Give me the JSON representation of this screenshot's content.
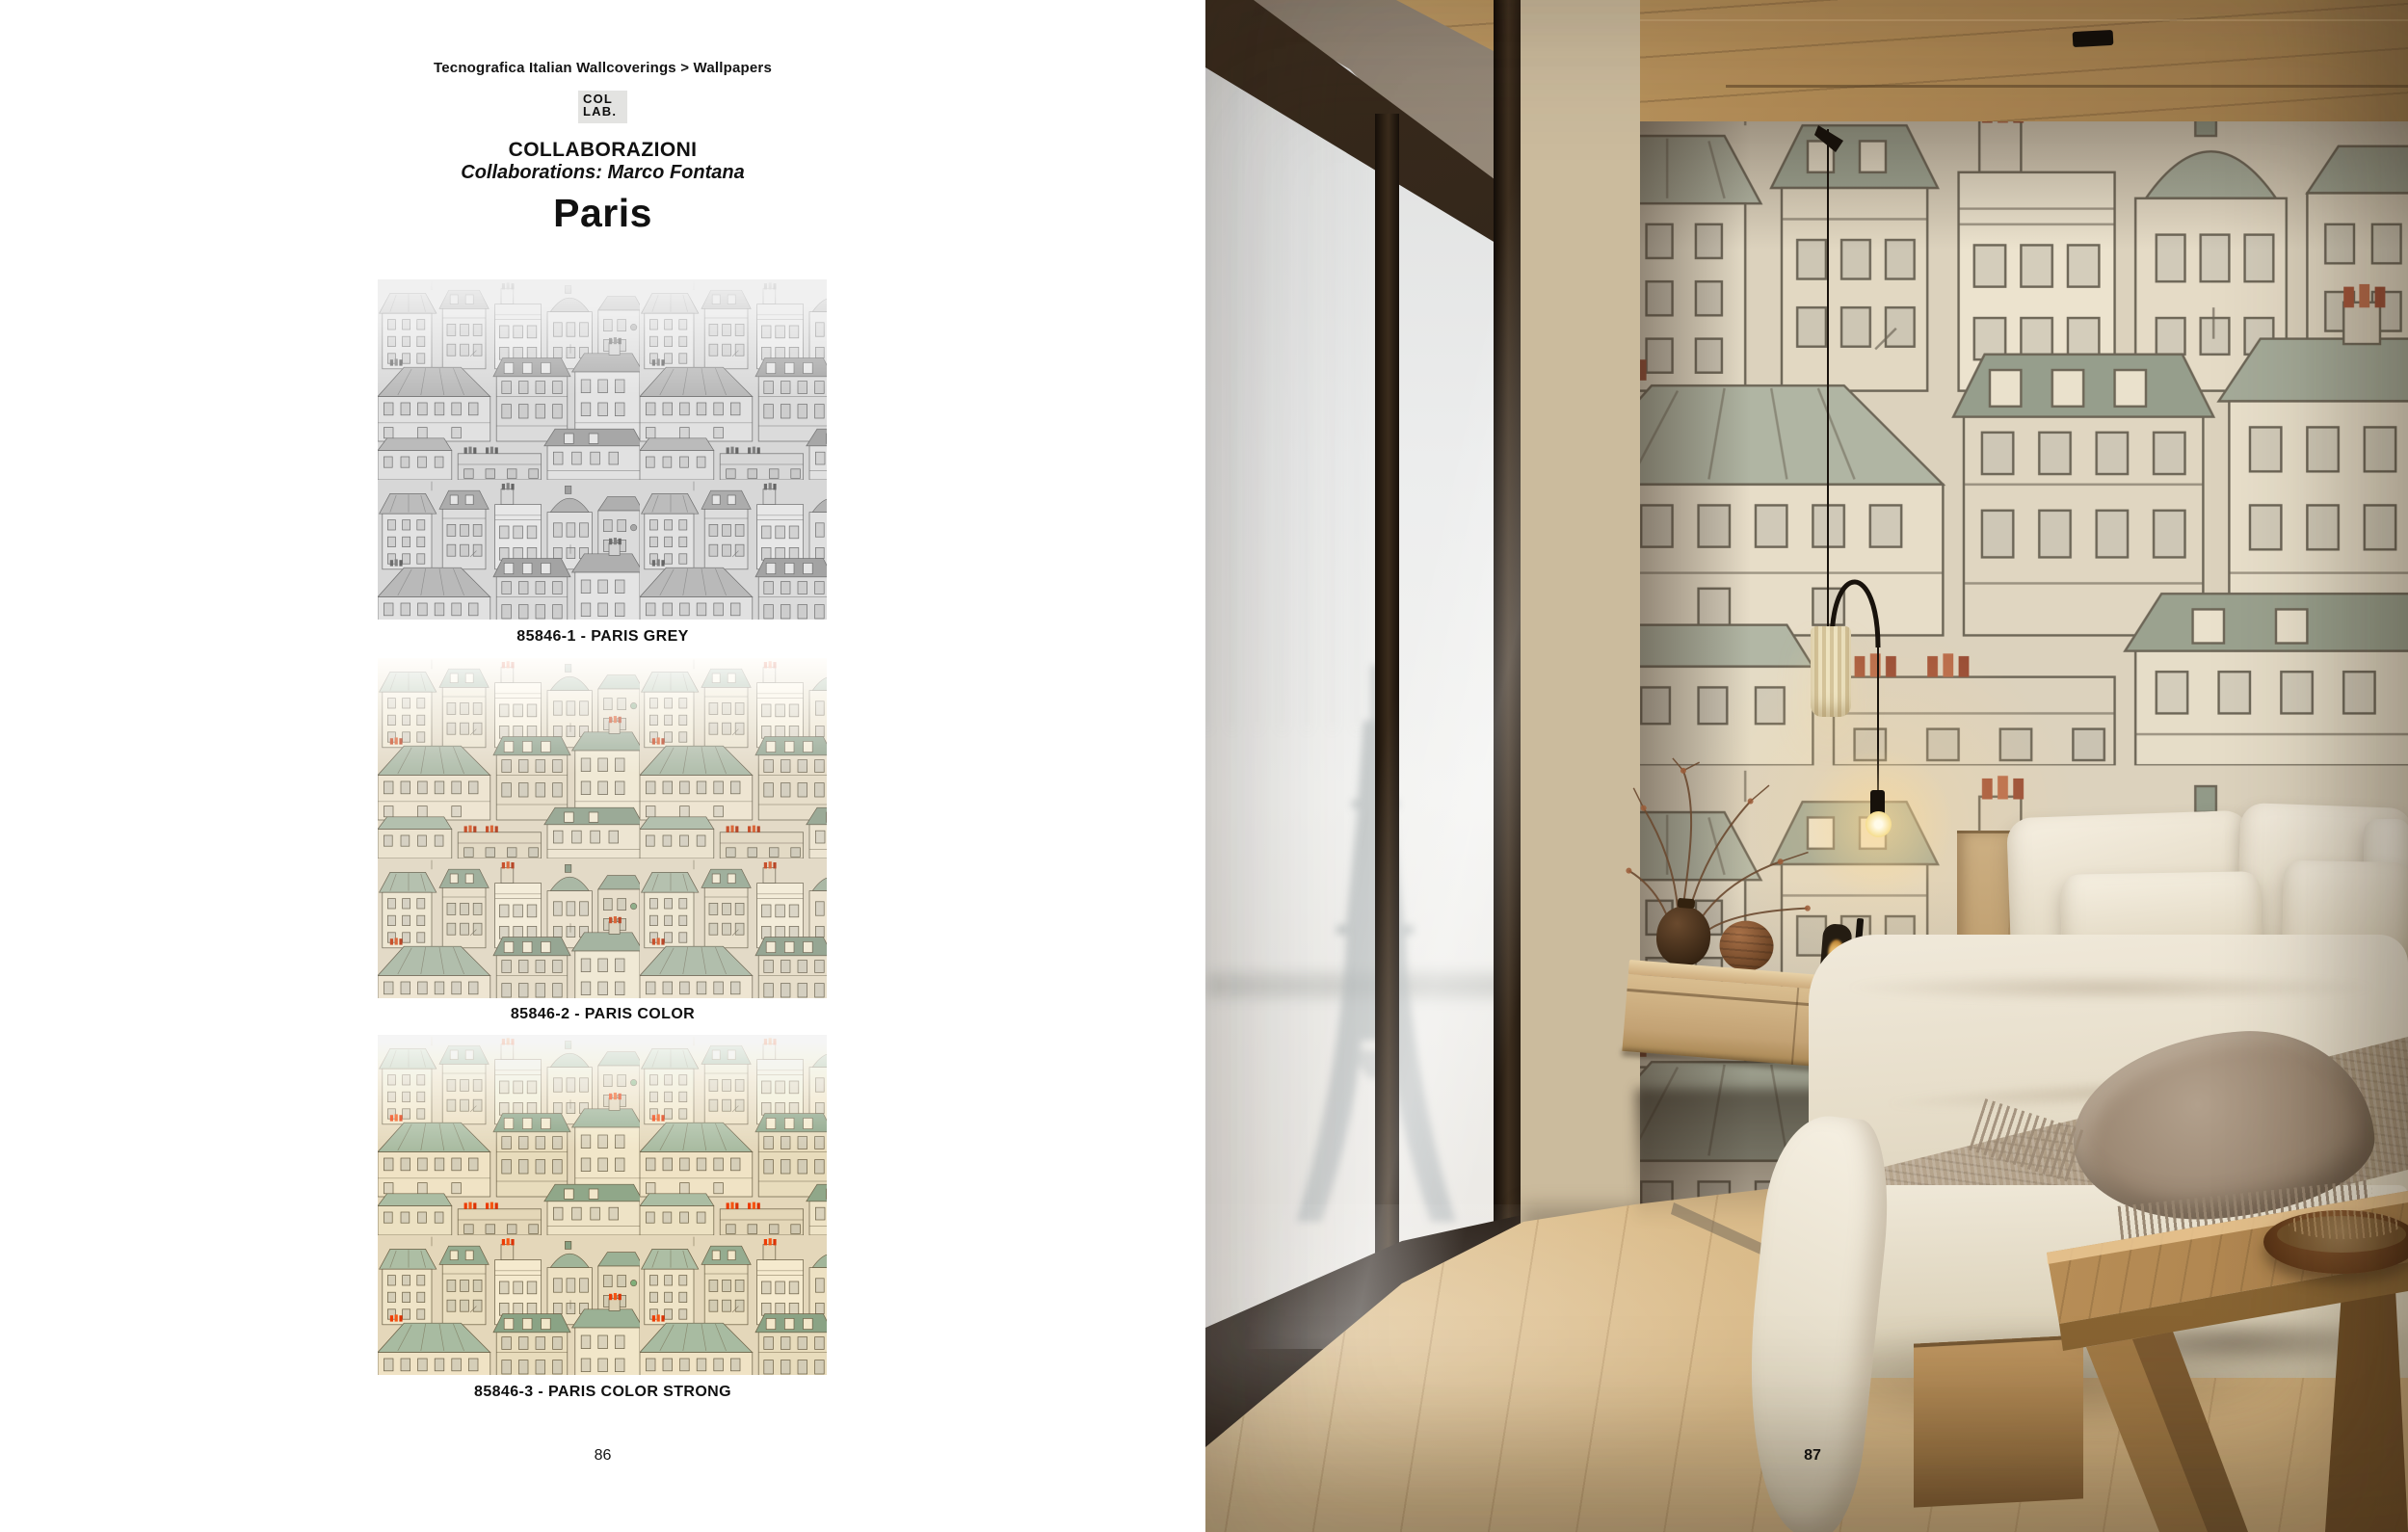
{
  "left_page": {
    "breadcrumb": "Tecnografica Italian Wallcoverings > Wallpapers",
    "logo": {
      "line1": "COL",
      "line2": "LAB."
    },
    "collection_heading": "COLLABORAZIONI",
    "collection_subheading": "Collaborations: Marco Fontana",
    "design_title": "Paris",
    "swatches": [
      {
        "code": "85846-1",
        "name": "PARIS GREY",
        "label": "85846-1 - PARIS GREY",
        "variant": "grey"
      },
      {
        "code": "85846-2",
        "name": "PARIS COLOR",
        "label": "85846-2 - PARIS COLOR",
        "variant": "color"
      },
      {
        "code": "85846-3",
        "name": "PARIS COLOR STRONG",
        "label": "85846-3 - PARIS COLOR STRONG",
        "variant": "color-strong"
      }
    ],
    "page_number": "86"
  },
  "right_page": {
    "page_number": "87"
  },
  "palette": {
    "wallpaper_paper": "#ded6c3",
    "wallpaper_line": "#6f6857",
    "wallpaper_roof_green": "#a5b2a0",
    "wallpaper_wall_cream": "#e9e2cf",
    "wallpaper_chimney_red": "#c14f2c",
    "ceiling_wood": "#b28f5e",
    "curtain": "#cbbb9d",
    "window_frame_bronze": "#2b2015",
    "floor_wood": "#dcc094",
    "rug": "#ccc5b8",
    "bed_linen": "#ece4d3",
    "throw": "#b3a28d"
  }
}
